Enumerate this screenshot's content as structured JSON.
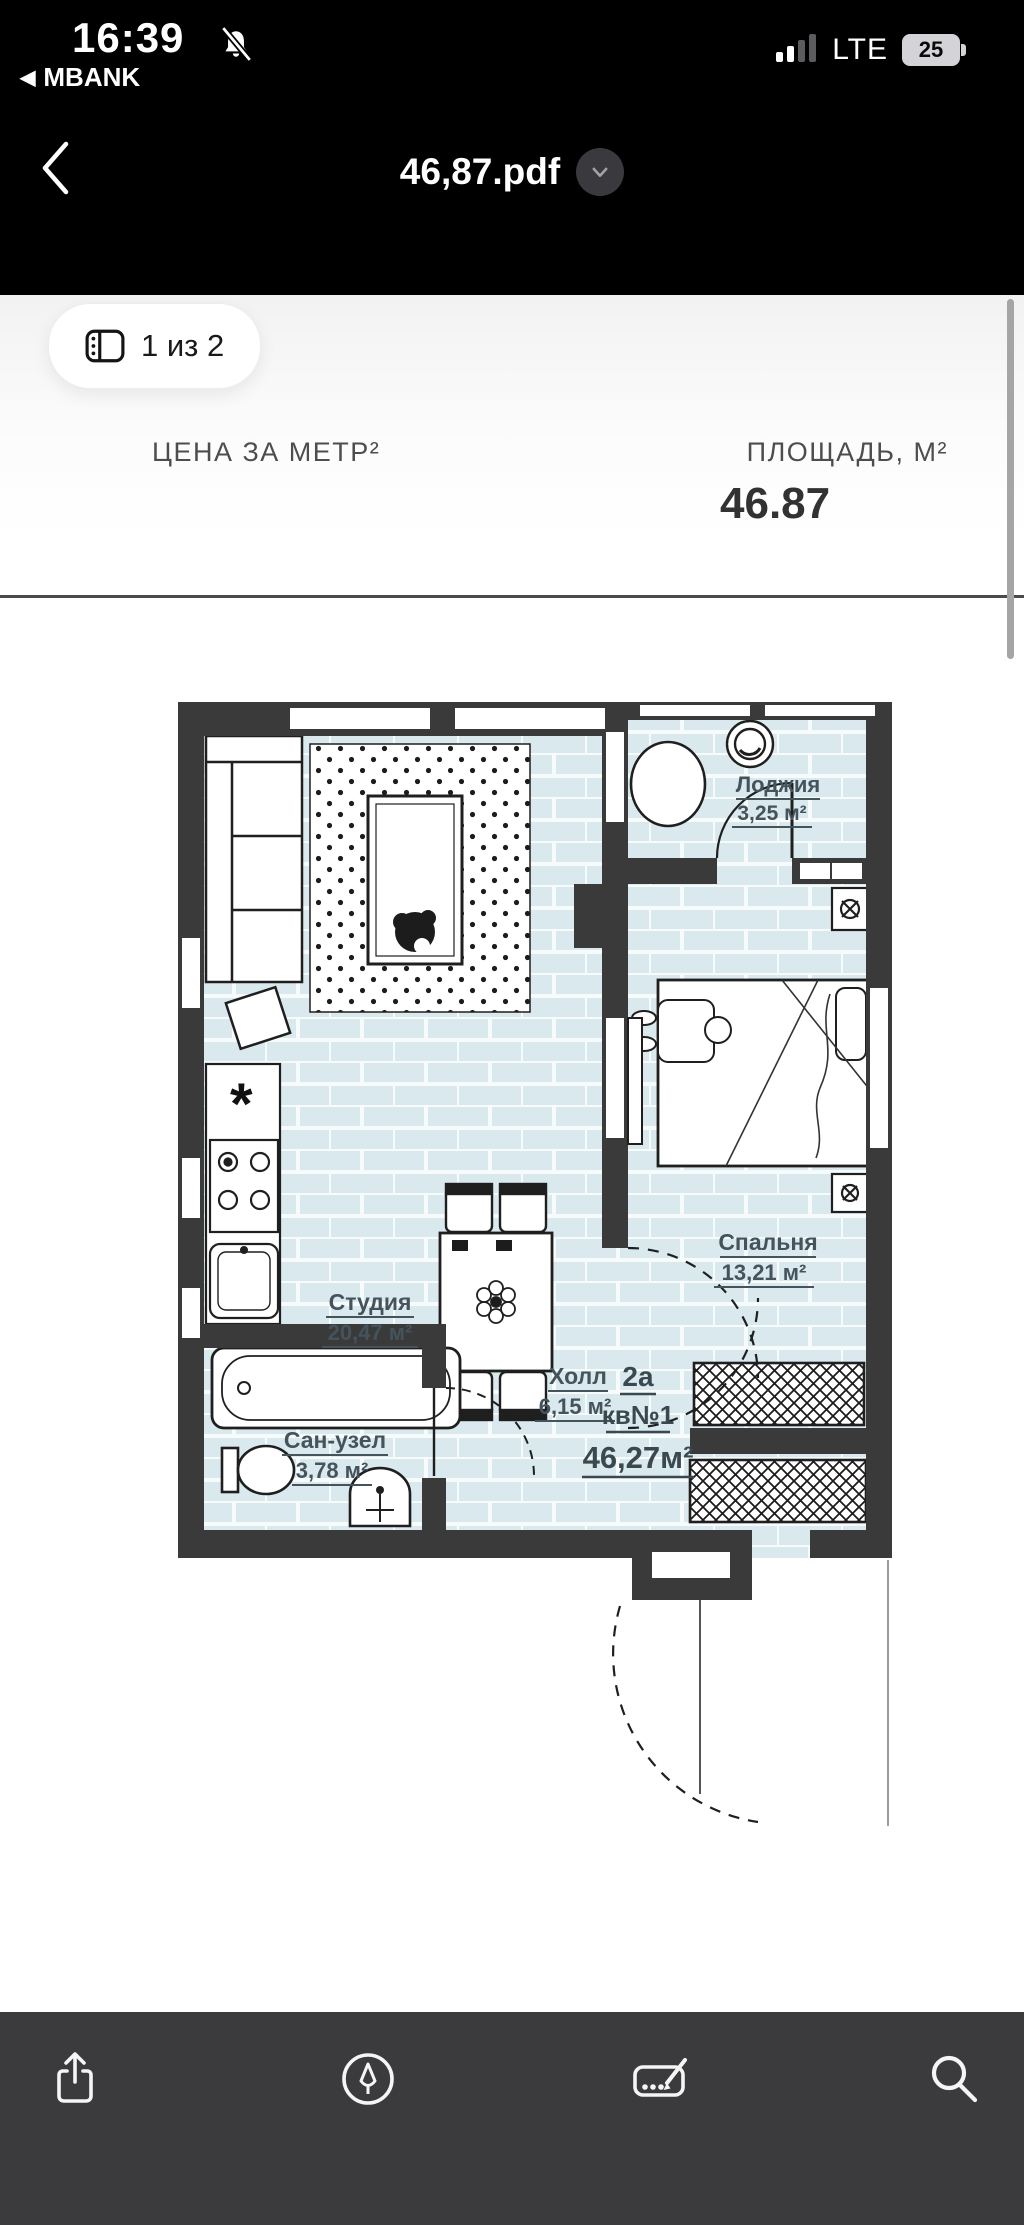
{
  "status_bar": {
    "time": "16:39",
    "back_app": "MBANK",
    "network": "LTE",
    "battery": "25"
  },
  "nav": {
    "title": "46,87.pdf"
  },
  "page_indicator": {
    "label": "1 из 2"
  },
  "document": {
    "price_label": "ЦЕНА ЗА МЕТР²",
    "area_label": "ПЛОЩАДЬ, М²",
    "area_value": "46.87"
  },
  "floor_plan": {
    "apartment": {
      "type": "2а",
      "unit": "кв№1",
      "total_area": "46,27м²"
    },
    "rooms": {
      "studio": {
        "name": "Студия",
        "area": "20,47 м²"
      },
      "loggia": {
        "name": "Лоджия",
        "area": "3,25 м²"
      },
      "bedroom": {
        "name": "Спальня",
        "area": "13,21 м²"
      },
      "hall": {
        "name": "Холл",
        "area": "6,15 м²"
      },
      "bathroom": {
        "name": "Сан-узел",
        "area": "3,78 м²"
      }
    }
  },
  "toolbar": {
    "icon_names": [
      "share",
      "markup",
      "signature",
      "search"
    ]
  },
  "colors": {
    "header_bg": "#000000",
    "toolbar_bg": "#3b3b3d",
    "wall": "#3a3a3a",
    "floor": "#d9e9ee",
    "room_label": "#44535c",
    "scrollbar": "#a5a5a5"
  }
}
